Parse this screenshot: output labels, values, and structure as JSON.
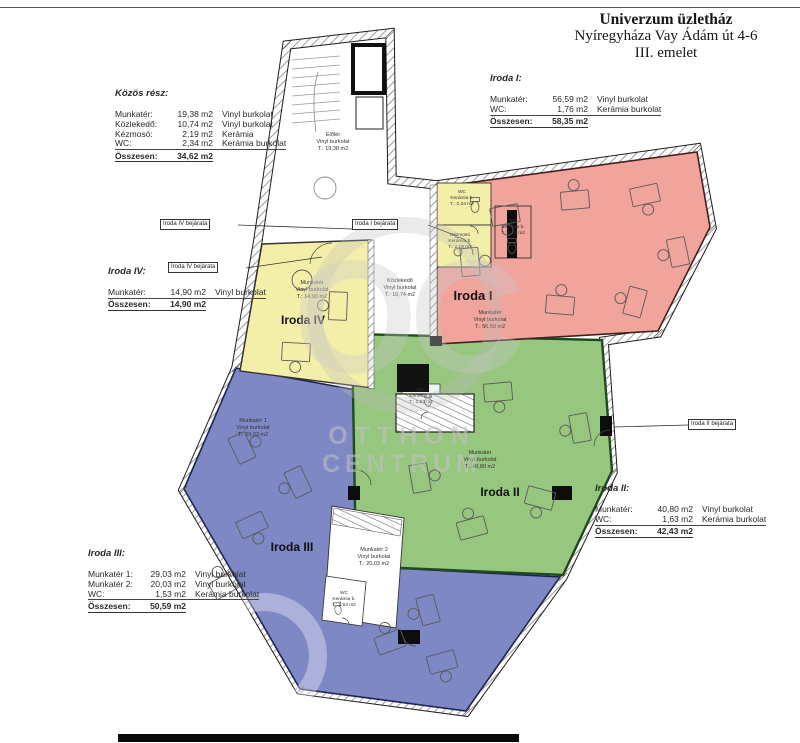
{
  "sheet": {
    "title_line1": "Univerzum üzletház",
    "title_line2": "Nyíregyháza Vay Ádám út 4-6",
    "title_line3": "III. emelet"
  },
  "legend_blocks": {
    "kozos": {
      "heading": "Közös rész:",
      "rows": [
        {
          "label": "Munkatér:",
          "value": "19,38 m2",
          "material": "Vinyl burkolat"
        },
        {
          "label": "Közlekedő:",
          "value": "10,74 m2",
          "material": "Vinyl burkolat"
        },
        {
          "label": "Kézmosó:",
          "value": "2,19 m2",
          "material": "Kerámia"
        },
        {
          "label": "WC:",
          "value": "2,34 m2",
          "material": "Kerámia burkolat"
        }
      ],
      "total_label": "Összesen:",
      "total_value": "34,62 m2"
    },
    "iroda1": {
      "heading": "Iroda I:",
      "rows": [
        {
          "label": "Munkatér:",
          "value": "56,59 m2",
          "material": "Vinyl burkolat"
        },
        {
          "label": "WC:",
          "value": "1,76 m2",
          "material": "Kerámia burkolat"
        }
      ],
      "total_label": "Összesen:",
      "total_value": "58,35 m2"
    },
    "iroda4": {
      "heading": "Iroda IV:",
      "rows": [
        {
          "label": "Munkatér:",
          "value": "14,90 m2",
          "material": "Vinyl burkolat"
        }
      ],
      "total_label": "Összesen:",
      "total_value": "14,90 m2"
    },
    "iroda2": {
      "heading": "Iroda II:",
      "rows": [
        {
          "label": "Munkatér:",
          "value": "40,80 m2",
          "material": "Vinyl burkolat"
        },
        {
          "label": "WC:",
          "value": "1,63 m2",
          "material": "Kerámia burkolat"
        }
      ],
      "total_label": "Összesen:",
      "total_value": "42,43 m2"
    },
    "iroda3": {
      "heading": "Iroda III:",
      "rows": [
        {
          "label": "Munkatér 1:",
          "value": "29,03 m2",
          "material": "Vinyl burkolat"
        },
        {
          "label": "Munkatér 2:",
          "value": "20,03 m2",
          "material": "Vinyl burkolat"
        },
        {
          "label": "WC:",
          "value": "1,53 m2",
          "material": "Kerámia burkolat"
        }
      ],
      "total_label": "Összesen:",
      "total_value": "50,59 m2"
    }
  },
  "entrance_labels": {
    "iroda4_a": "Iroda IV bejárata",
    "iroda4_b": "Iroda IV bejárata",
    "iroda1": "Iroda I bejárata",
    "iroda2": "Iroda II bejárata"
  },
  "plan": {
    "rooms": {
      "iroda1": {
        "name": "Iroda I",
        "info": [
          "Munkatér",
          "Vinyl burkolat",
          "T.: 56,59 m2"
        ]
      },
      "iroda2": {
        "name": "Iroda II",
        "info": [
          "Munkatér",
          "Vinyl burkolat",
          "T.: 40,80 m2"
        ]
      },
      "iroda3": {
        "name": "Iroda III",
        "info1": [
          "Munkatér 1",
          "Vinyl burkolat",
          "T.: 29,03 m2"
        ],
        "info2": [
          "Munkatér 2",
          "Vinyl burkolat",
          "T.: 20,03 m2"
        ]
      },
      "iroda4": {
        "name": "Iroda IV",
        "info": [
          "Munkatér",
          "Vinyl burkolat",
          "T.: 14,90 m2"
        ]
      },
      "eloter": {
        "info": [
          "Előtér",
          "Vinyl burkolat",
          "T.: 19,38 m2"
        ]
      },
      "kozlekedo": {
        "info": [
          "Közlekedő",
          "Vinyl burkolat",
          "T.: 10,74 m2"
        ]
      },
      "wc_kozos": {
        "info": [
          "WC",
          "Kerámia b.",
          "T.: 2,34 m2"
        ]
      },
      "kezmoso": {
        "info": [
          "Kézmosó",
          "Kerámia b.",
          "T.: 2,19 m2"
        ]
      },
      "wc_iroda1": {
        "info": [
          "WC",
          "Kerámia b.",
          "T.: 1,76 m2"
        ]
      },
      "wc_iroda2": {
        "info": [
          "WC",
          "Kerámia b.",
          "T.: 1,63 m2"
        ]
      },
      "wc_iroda3": {
        "info": [
          "WC",
          "Kerámia b.",
          "T.: 1,53 m2"
        ]
      }
    },
    "colors": {
      "iroda1": "#f1a49c",
      "iroda2": "#97c67e",
      "iroda3": "#7e88c4",
      "iroda4": "#f4efa8"
    },
    "watermark": {
      "monogram": "OC",
      "line1": "OTTHON",
      "line2": "CENTRUM"
    }
  }
}
